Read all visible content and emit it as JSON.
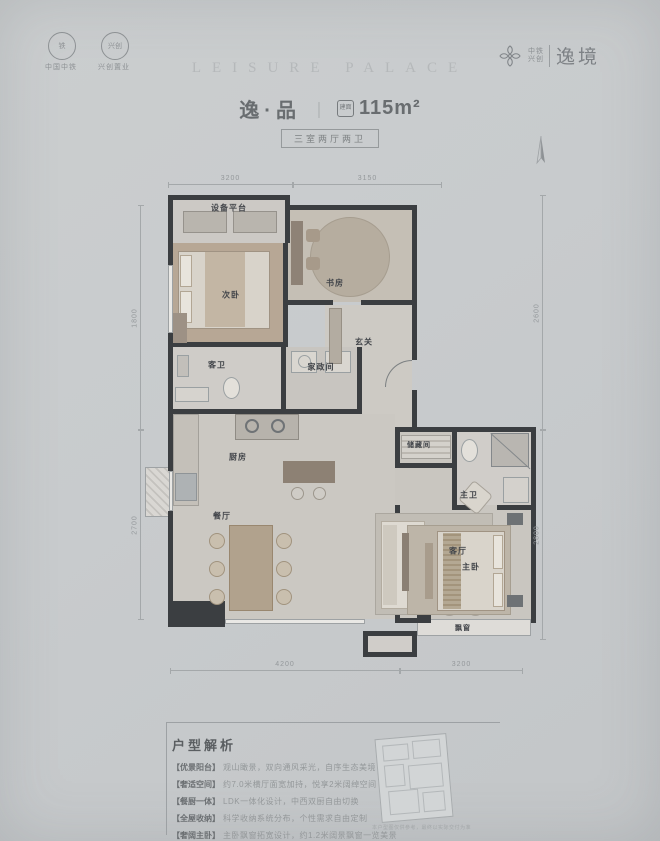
{
  "header": {
    "seal_primary": "中国中铁",
    "seal_secondary": "兴创置业",
    "brand_small_1": "中铁",
    "brand_small_2": "兴创",
    "brand_name": "逸境",
    "title_en": "LEISURE PALACE",
    "unit_name": "逸·品",
    "divider": "｜",
    "area_icon_label": "建面",
    "area_value": "115m²",
    "layout_badge": "三室两厅两卫"
  },
  "floorplan": {
    "rooms": {
      "platform": "设备平台",
      "bedroom2": "次卧",
      "study": "书房",
      "foyer": "玄关",
      "guest_bath": "客卫",
      "laundry": "家政间",
      "kitchen": "厨房",
      "dining": "餐厅",
      "living": "客厅",
      "storage": "储藏间",
      "master_bath": "主卫",
      "master_bed": "主卧",
      "bay_window": "飘窗"
    },
    "dims": {
      "top": [
        "3200",
        "3150"
      ],
      "bottom": [
        "4200",
        "3200"
      ],
      "left": [
        "1800",
        "2700"
      ],
      "right": [
        "2600",
        "2800"
      ]
    }
  },
  "analysis": {
    "title": "户型解析",
    "items": [
      {
        "tag": "【优景阳台】",
        "text": "观山瞰景，双向通风采光，自序生态美境"
      },
      {
        "tag": "【奢适空间】",
        "text": "约7.0米横厅面宽加持，悦享2米阔绰空间"
      },
      {
        "tag": "【餐厨一体】",
        "text": "LDK一体化设计，中西双厨自由切换"
      },
      {
        "tag": "【全屋收纳】",
        "text": "科学收纳系统分布，个性需求自由定制"
      },
      {
        "tag": "【奢阔主卧】",
        "text": "主卧飘窗拓宽设计，约1.2米阔景飘窗一览美景"
      }
    ],
    "thumbnail_caption": "本户型图仅供参考，最终以实际交付为准"
  },
  "colors": {
    "wall": "#3b3e41",
    "background": "#c9cccd"
  }
}
